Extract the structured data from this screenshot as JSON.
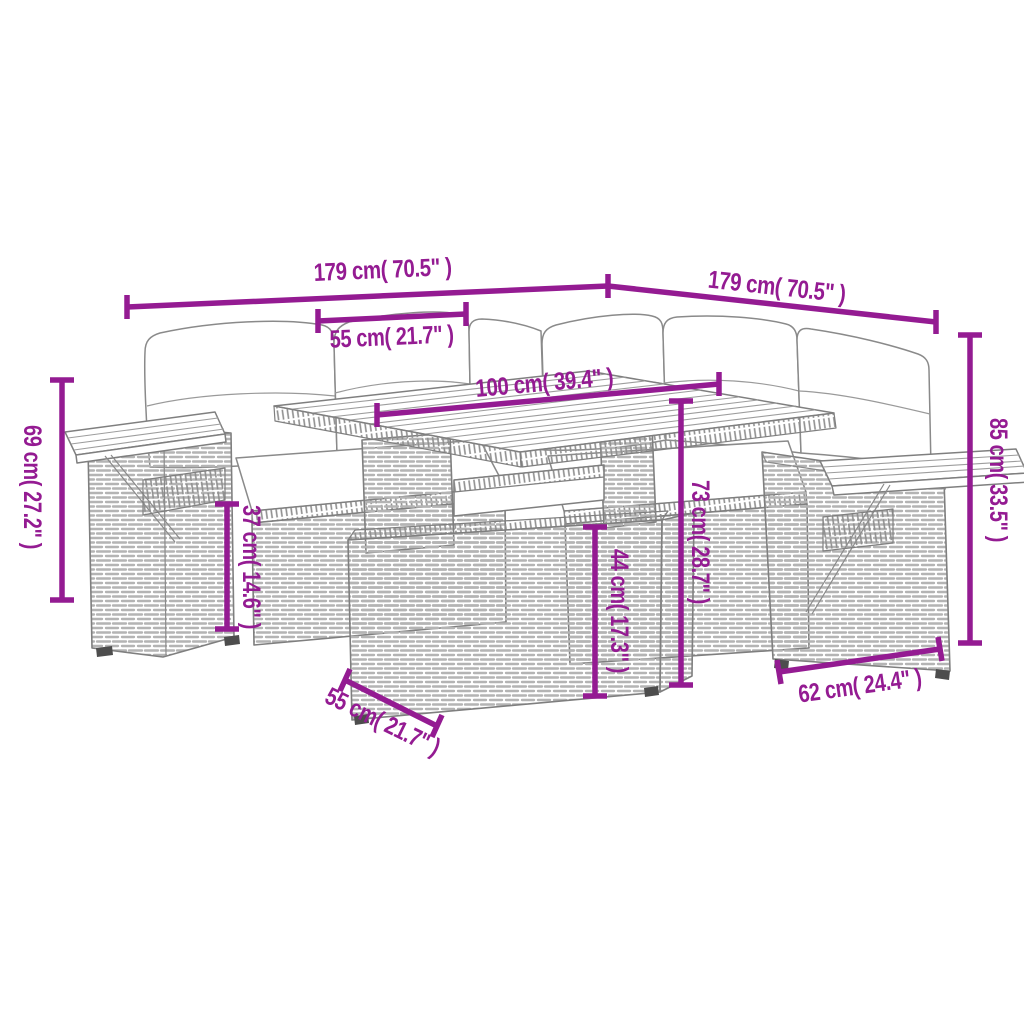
{
  "diagram": {
    "type": "product-dimension-diagram",
    "subject": "poly-rattan garden lounge set with cushions, folding side trays, slatted wood table and ottoman",
    "background_color": "#FFFFFF",
    "accent_color": "#941B92",
    "linework_color": "#828282"
  },
  "dims": {
    "width_left": "179 cm( 70.5\" )",
    "width_right": "179 cm( 70.5\" )",
    "seat_width": "55 cm( 21.7\" )",
    "table_length": "100 cm( 39.4\" )",
    "back_height_left": "69 cm( 27.2\" )",
    "seat_height": "37 cm( 14.6\" )",
    "table_height": "73 cm( 28.7\" )",
    "ottoman_height": "44 cm( 17.3\" )",
    "back_height_right": "85 cm( 33.5\" )",
    "armrest_depth": "62 cm( 24.4\" )",
    "ottoman_width": "55 cm( 21.7\" )"
  }
}
